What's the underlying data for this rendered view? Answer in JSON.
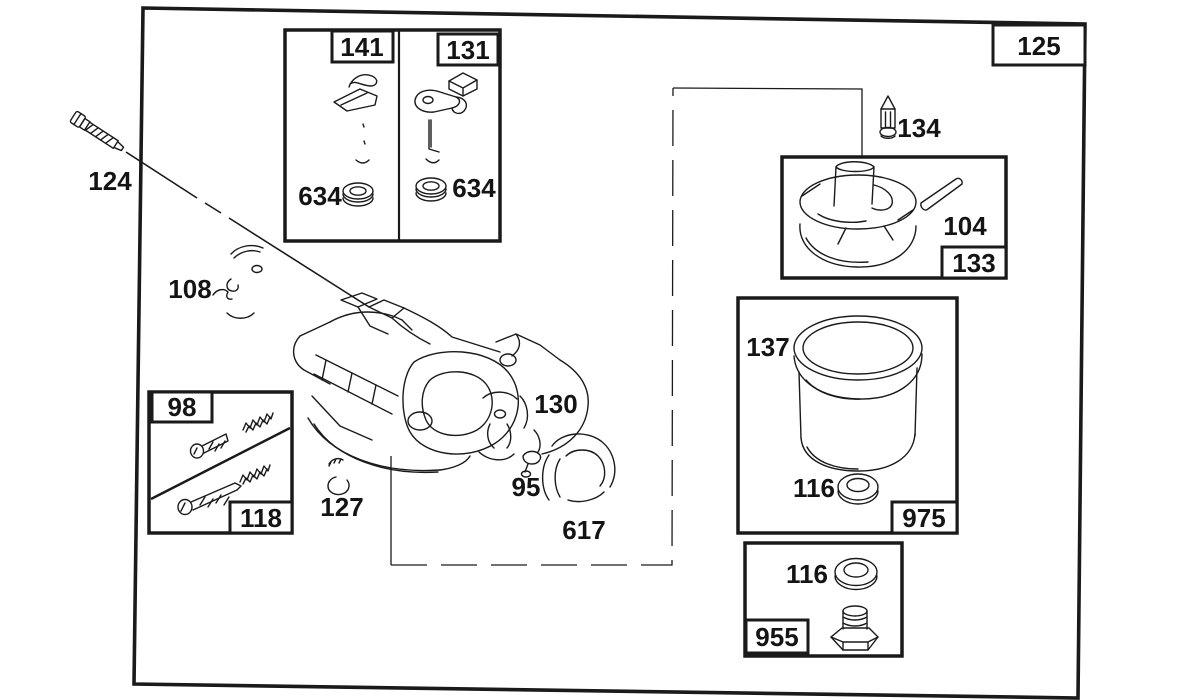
{
  "colors": {
    "background": "#ffffff",
    "ink": "#1a1a1a"
  },
  "labels": {
    "l125": "125",
    "l124": "124",
    "l108": "108",
    "l141": "141",
    "l131": "131",
    "l634a": "634",
    "l634b": "634",
    "l134": "134",
    "l104": "104",
    "l133": "133",
    "l137": "137",
    "l116a": "116",
    "l975": "975",
    "l116b": "116",
    "l955": "955",
    "l130": "130",
    "l95": "95",
    "l617": "617",
    "l127": "127",
    "l98": "98",
    "l118": "118"
  }
}
